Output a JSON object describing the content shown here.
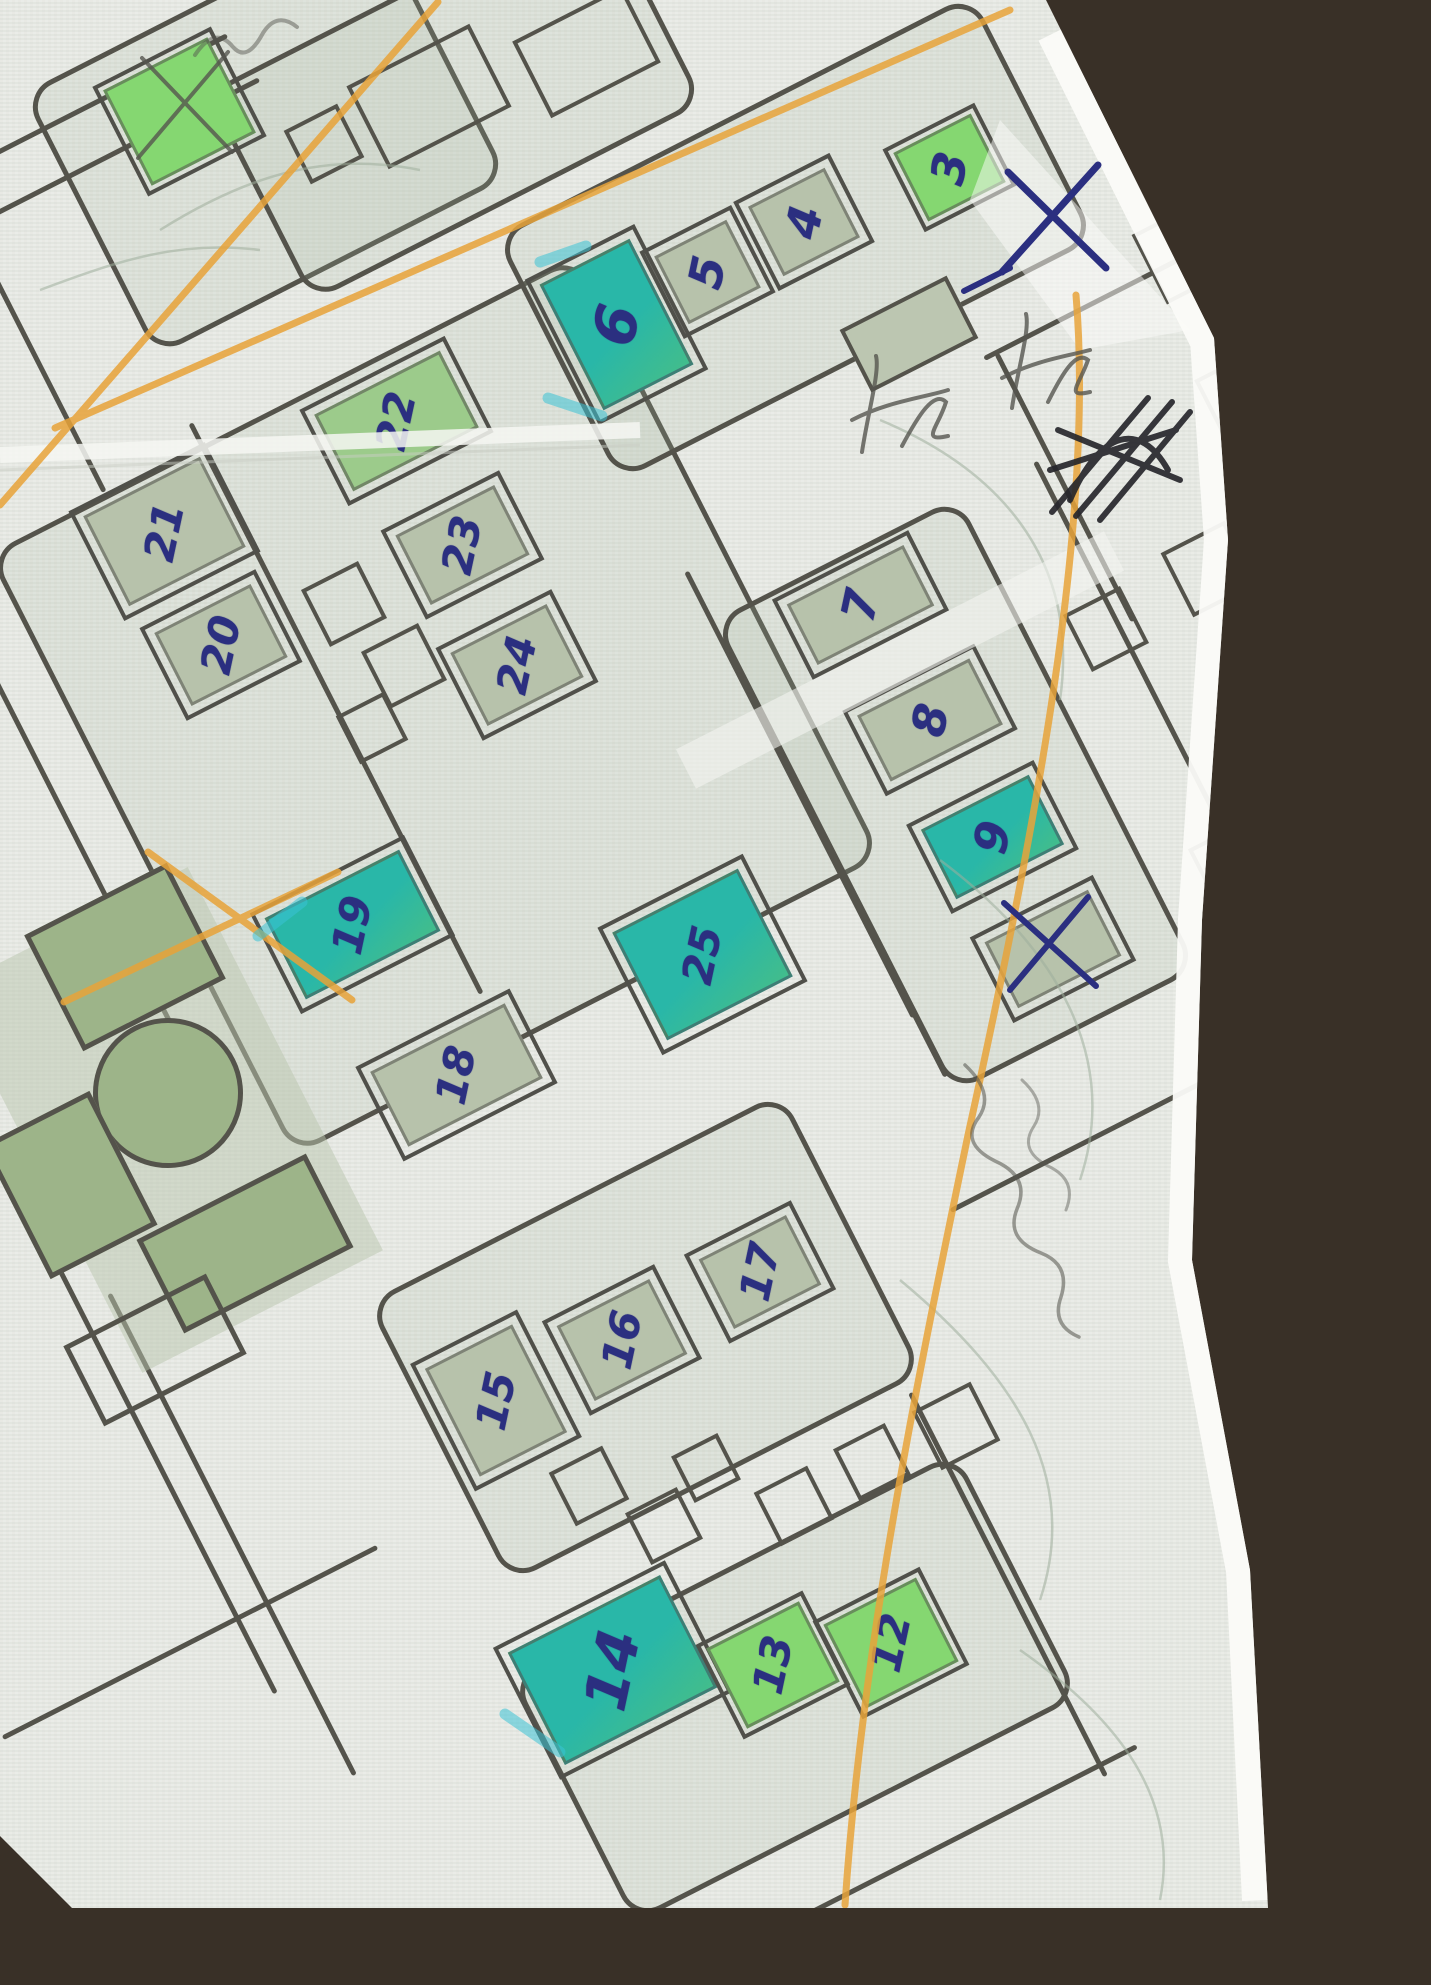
{
  "scene": "hand-annotated street map photograph on dark table",
  "colors": {
    "paper": "#e9ebe6",
    "road_line": "#54534b",
    "building_pale": "#b7c2ab",
    "building_medium_green": "#9ccb8b",
    "building_bright_green": "#85d771",
    "building_teal_highlight": "#29b7a8",
    "ink_blue": "#2b2f80",
    "ink_black": "#26262c",
    "pencil_gray": "#55554f",
    "highlighter_orange": "#e8a339",
    "highlighter_cyan": "#3bc3d6",
    "park_green": "#9db489",
    "table_brown": "#393027"
  },
  "buildings": {
    "b3": {
      "label": "3",
      "style": "bright-green"
    },
    "b4": {
      "label": "4",
      "style": "pale-green"
    },
    "b5": {
      "label": "5",
      "style": "pale-green"
    },
    "b6": {
      "label": "6",
      "style": "teal-highlight"
    },
    "b7": {
      "label": "7",
      "style": "pale-green"
    },
    "b8": {
      "label": "8",
      "style": "pale-green"
    },
    "b9": {
      "label": "9",
      "style": "teal-highlight"
    },
    "b12": {
      "label": "12",
      "style": "bright-green"
    },
    "b13": {
      "label": "13",
      "style": "bright-green"
    },
    "b14": {
      "label": "14",
      "style": "teal-highlight"
    },
    "b15": {
      "label": "15",
      "style": "pale-green"
    },
    "b16": {
      "label": "16",
      "style": "pale-green"
    },
    "b17": {
      "label": "17",
      "style": "pale-green"
    },
    "b18": {
      "label": "18",
      "style": "pale-green"
    },
    "b19": {
      "label": "19",
      "style": "teal-highlight"
    },
    "b20": {
      "label": "20",
      "style": "pale-green"
    },
    "b21": {
      "label": "21",
      "style": "pale-green"
    },
    "b22": {
      "label": "22",
      "style": "medium-green"
    },
    "b23": {
      "label": "23",
      "style": "pale-green"
    },
    "b24": {
      "label": "24",
      "style": "pale-green"
    },
    "b25": {
      "label": "25",
      "style": "teal-highlight"
    },
    "crossed_right": {
      "label": "",
      "style": "pale-green crossed with blue ink X"
    },
    "crossed_topleft": {
      "label": "",
      "style": "bright-green crossed with pencil X"
    }
  },
  "annotations": {
    "ink_x_top_right": "large blue ink X on paper margin",
    "ink_scribble_right_edge": "dense black ink scribble",
    "pencil_scribble_1": "illegible pencil scribble near buildings 4-5",
    "pencil_scribble_2": "illegible pencil scribble near building 3",
    "pencil_note_right_margin": "illegible cursive pencil note",
    "pencil_note_top_edge": "illegible cursive pencil mark",
    "orange_lines": "orange highlighter route lines (top-left diagonal, top road, right edge, bottom-left X)"
  },
  "park": {
    "features": [
      "outlined tree circle",
      "green vegetation patches",
      "empty lot outline"
    ]
  }
}
